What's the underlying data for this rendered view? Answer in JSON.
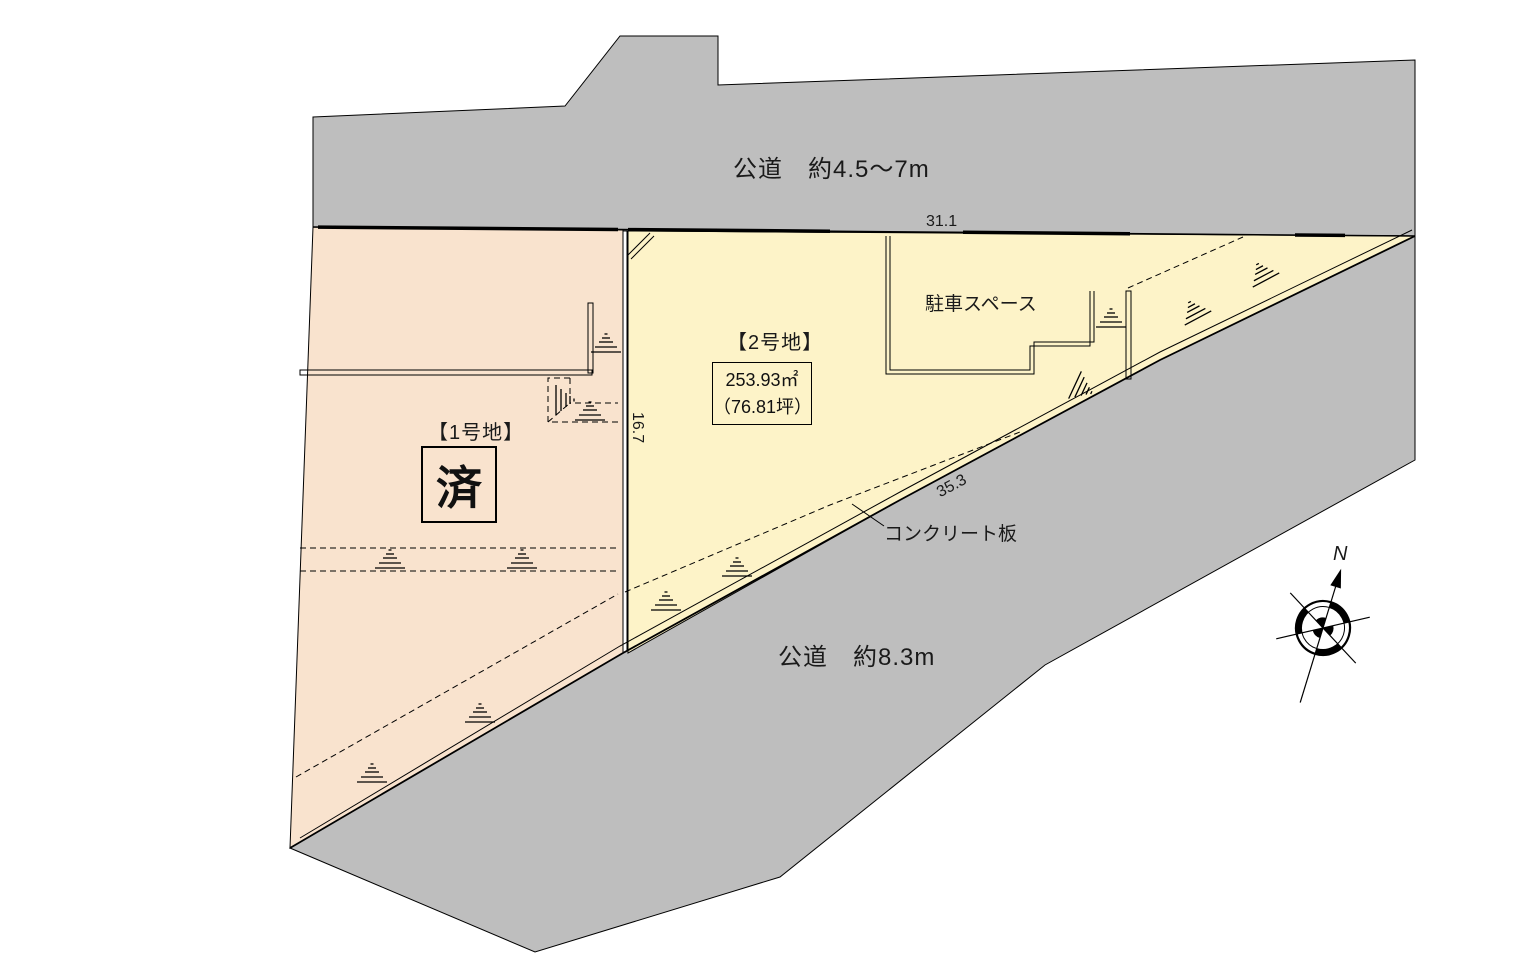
{
  "roads": {
    "top": {
      "label": "公道　約4.5〜7m"
    },
    "bottom": {
      "label": "公道　約8.3m"
    }
  },
  "lots": {
    "lot1": {
      "name": "【1号地】",
      "status_label": "済"
    },
    "lot2": {
      "name": "【2号地】",
      "area_sqm": "253.93㎡",
      "area_tsubo": "（76.81坪）",
      "parking_label": "駐車スペース"
    }
  },
  "dimensions": {
    "top_edge": "31.1",
    "left_edge": "16.7",
    "diagonal_edge": "35.3"
  },
  "annotations": {
    "concrete_plate": "コンクリート板",
    "compass_north": "N"
  },
  "colors": {
    "road": "#bebebe",
    "lot1": "#f9e3ce",
    "lot2": "#fdf3c8",
    "line": "#000000"
  }
}
